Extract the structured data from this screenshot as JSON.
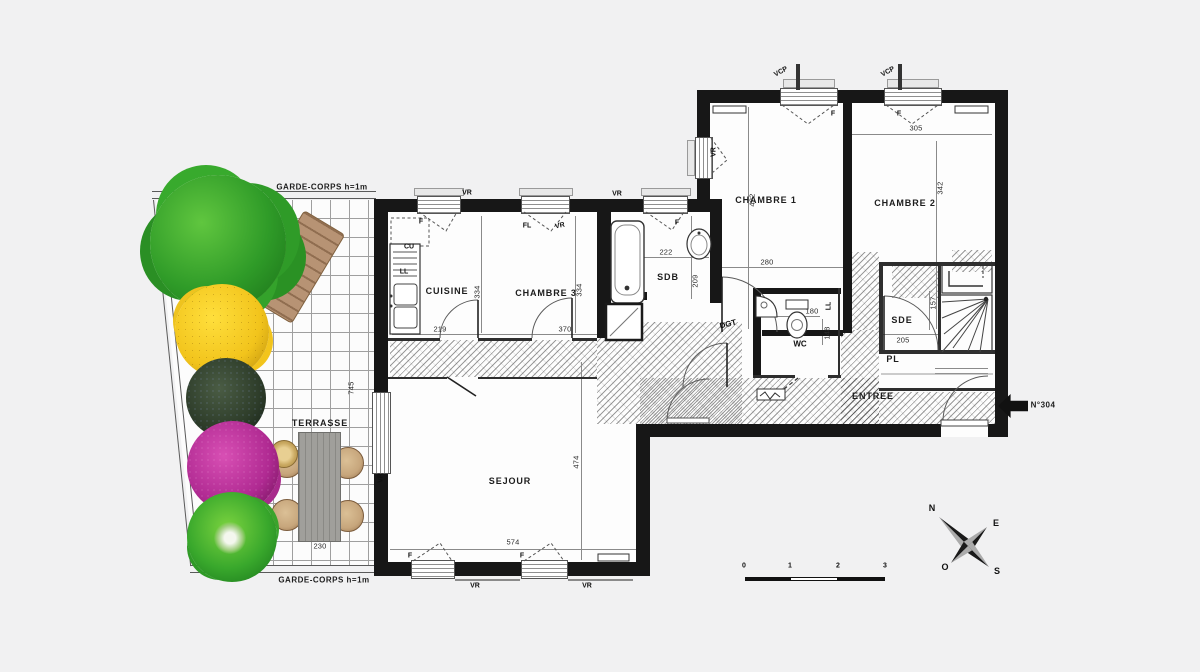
{
  "labels": {
    "garde_corps": "GARDE-CORPS h=1m",
    "terrasse": "TERRASSE",
    "entree": "ENTREE",
    "unit": "N°304",
    "dgt": "DGT",
    "pl": "PL",
    "sde": "SDE",
    "sdb": "SDB",
    "wc": "WC",
    "cuisine": "CUISINE",
    "chambre1": "CHAMBRE 1",
    "chambre2": "CHAMBRE 2",
    "chambre3": "CHAMBRE 3",
    "sejour": "SEJOUR",
    "cu": "CU",
    "ll": "LL",
    "fl": "FL",
    "f": "F",
    "vr": "VR",
    "vcp": "VCP"
  },
  "dimensions": {
    "cuisine_w": "219",
    "cuisine_h": "334",
    "chambre3_w": "370",
    "chambre3_h": "334",
    "sdb_w": "222",
    "sdb_h": "209",
    "chambre1_w": "280",
    "chambre1_h": "422",
    "chambre2_w": "305",
    "chambre2_h": "342",
    "wc_w": "180",
    "wc_h": "148",
    "sde_w": "205",
    "sde_h": "157",
    "sejour_w": "574",
    "sejour_h": "474",
    "terrasse_w": "230",
    "terrasse_h": "745"
  },
  "compass": {
    "north": "N",
    "east": "E",
    "south": "S",
    "west": "O"
  },
  "scale_bar": {
    "ticks": [
      "0",
      "1",
      "2",
      "3"
    ]
  },
  "colors": {
    "background": "#f1f1f2",
    "wall": "#171717",
    "paper": "#fdfdfd",
    "tree_green": "#2f9b28",
    "bush_yellow": "#f2c41c",
    "bush_dark": "#2e3d2a",
    "bush_magenta": "#b02a92",
    "plant_green": "#39a82c",
    "table_wood": "#a09f9b",
    "lounger_wood": "#b79374",
    "chair_rattan": "#c7a67c"
  }
}
